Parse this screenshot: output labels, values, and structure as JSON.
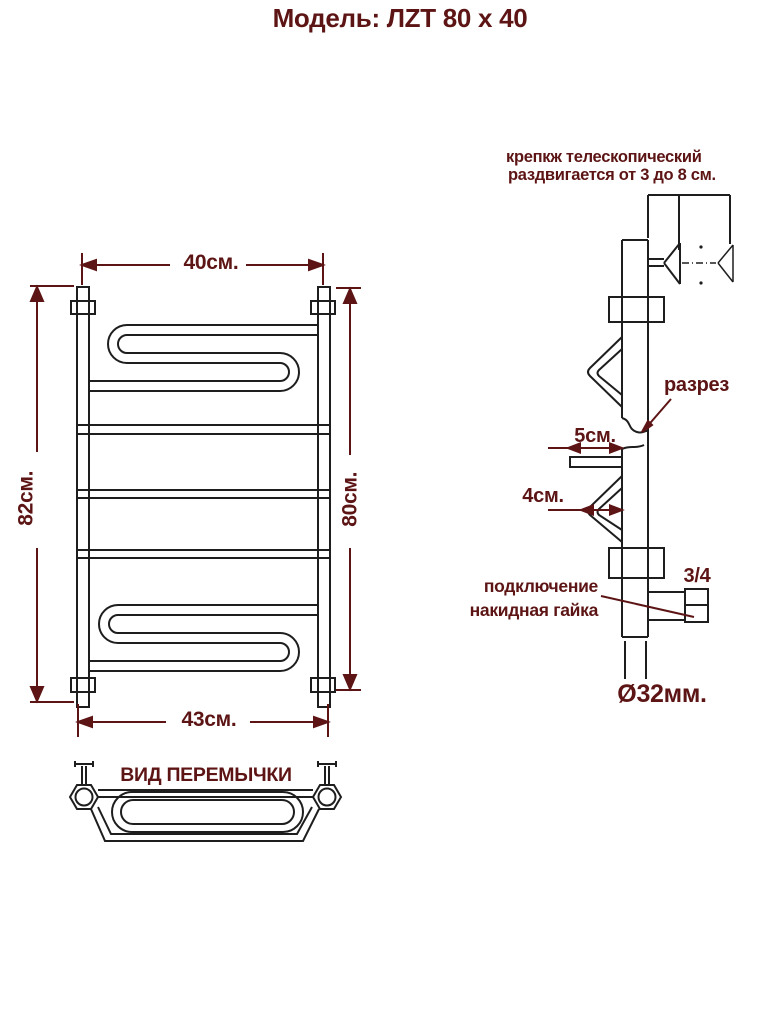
{
  "title": "Модель: ЛZТ 80 х 40",
  "colors": {
    "annotation": "#5c1414",
    "line": "#1e1e1e",
    "background": "#ffffff"
  },
  "front_view": {
    "dim_top": "40см.",
    "dim_left": "82см.",
    "dim_right": "80см.",
    "dim_bottom": "43см."
  },
  "side_view": {
    "mount_note_line1": "крепкж телескопический",
    "mount_note_line2": "раздвигается от 3 до 8 см.",
    "section_label": "разрез",
    "dim_shelf": "5см.",
    "dim_bend": "4см.",
    "thread_size": "3/4",
    "connection_line1": "подключение",
    "connection_line2": "накидная гайка",
    "pipe_diameter": "Ø32мм."
  },
  "crossbar_view": {
    "title": "ВИД ПЕРЕМЫЧКИ"
  }
}
